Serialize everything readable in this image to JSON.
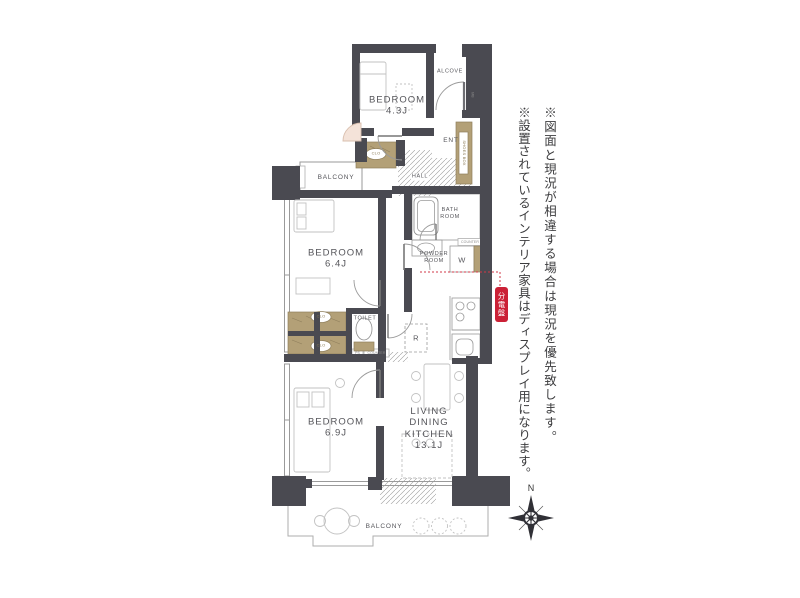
{
  "colors": {
    "wall": "#4a4a51",
    "closet": "#b3a077",
    "accent_red": "#cb2136",
    "line_gray": "#9a9a9a",
    "text_gray": "#55555a"
  },
  "rooms": {
    "bedroom_top": {
      "name": "BEDROOM",
      "size": "4.3J"
    },
    "bedroom_mid": {
      "name": "BEDROOM",
      "size": "6.4J"
    },
    "bedroom_low": {
      "name": "BEDROOM",
      "size": "6.9J"
    },
    "ldk": {
      "l1": "LIVING",
      "l2": "DINING",
      "l3": "KITCHEN",
      "size": "13.1J"
    },
    "bath": {
      "l1": "BATH",
      "l2": "ROOM"
    },
    "powder": {
      "l1": "POWDER",
      "l2": "ROOM"
    },
    "toilet": "TOILET",
    "hall": "HALL",
    "ent": "ENT",
    "alcove": "ALCOVE",
    "balcony_top": "BALCONY",
    "balcony_bottom": "BALCONY"
  },
  "fixtures": {
    "washer": "W",
    "fridge": "R",
    "closet": "CLO",
    "shoes_box": "SHOES BOX",
    "meter_box": "MB",
    "counter": "COUNTER",
    "pipe_space": "PS",
    "breaker_panel": "分電盤"
  },
  "notes": {
    "disclaimer1": "※図面と現況が相違する場合は現況を優先致します。",
    "disclaimer2": "※設置されているインテリア家具はディスプレイ用になります。"
  },
  "compass": {
    "north_label": "N"
  }
}
